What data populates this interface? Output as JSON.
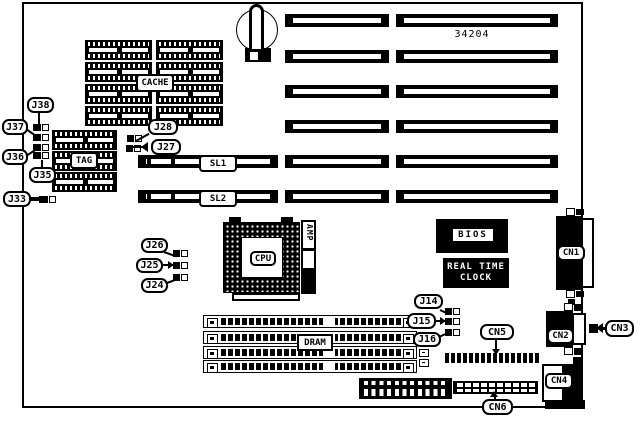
{
  "diagram": {
    "board_number": "34204",
    "labels": {
      "cache": "CACHE",
      "tag": "TAG",
      "cpu": "CPU",
      "amp": "AMP",
      "dram": "DRAM",
      "bios": "BIOS",
      "rtc_line1": "REAL TIME",
      "rtc_line2": "CLOCK",
      "sl1": "SL1",
      "sl2": "SL2",
      "j14": "J14",
      "j15": "J15",
      "j16": "J16",
      "j24": "J24",
      "j25": "J25",
      "j26": "J26",
      "j27": "J27",
      "j28": "J28",
      "j33": "J33",
      "j35": "J35",
      "j36": "J36",
      "j37": "J37",
      "j38": "J38",
      "cn1": "CN1",
      "cn2": "CN2",
      "cn3": "CN3",
      "cn4": "CN4",
      "cn5": "CN5",
      "cn6": "CN6"
    }
  }
}
